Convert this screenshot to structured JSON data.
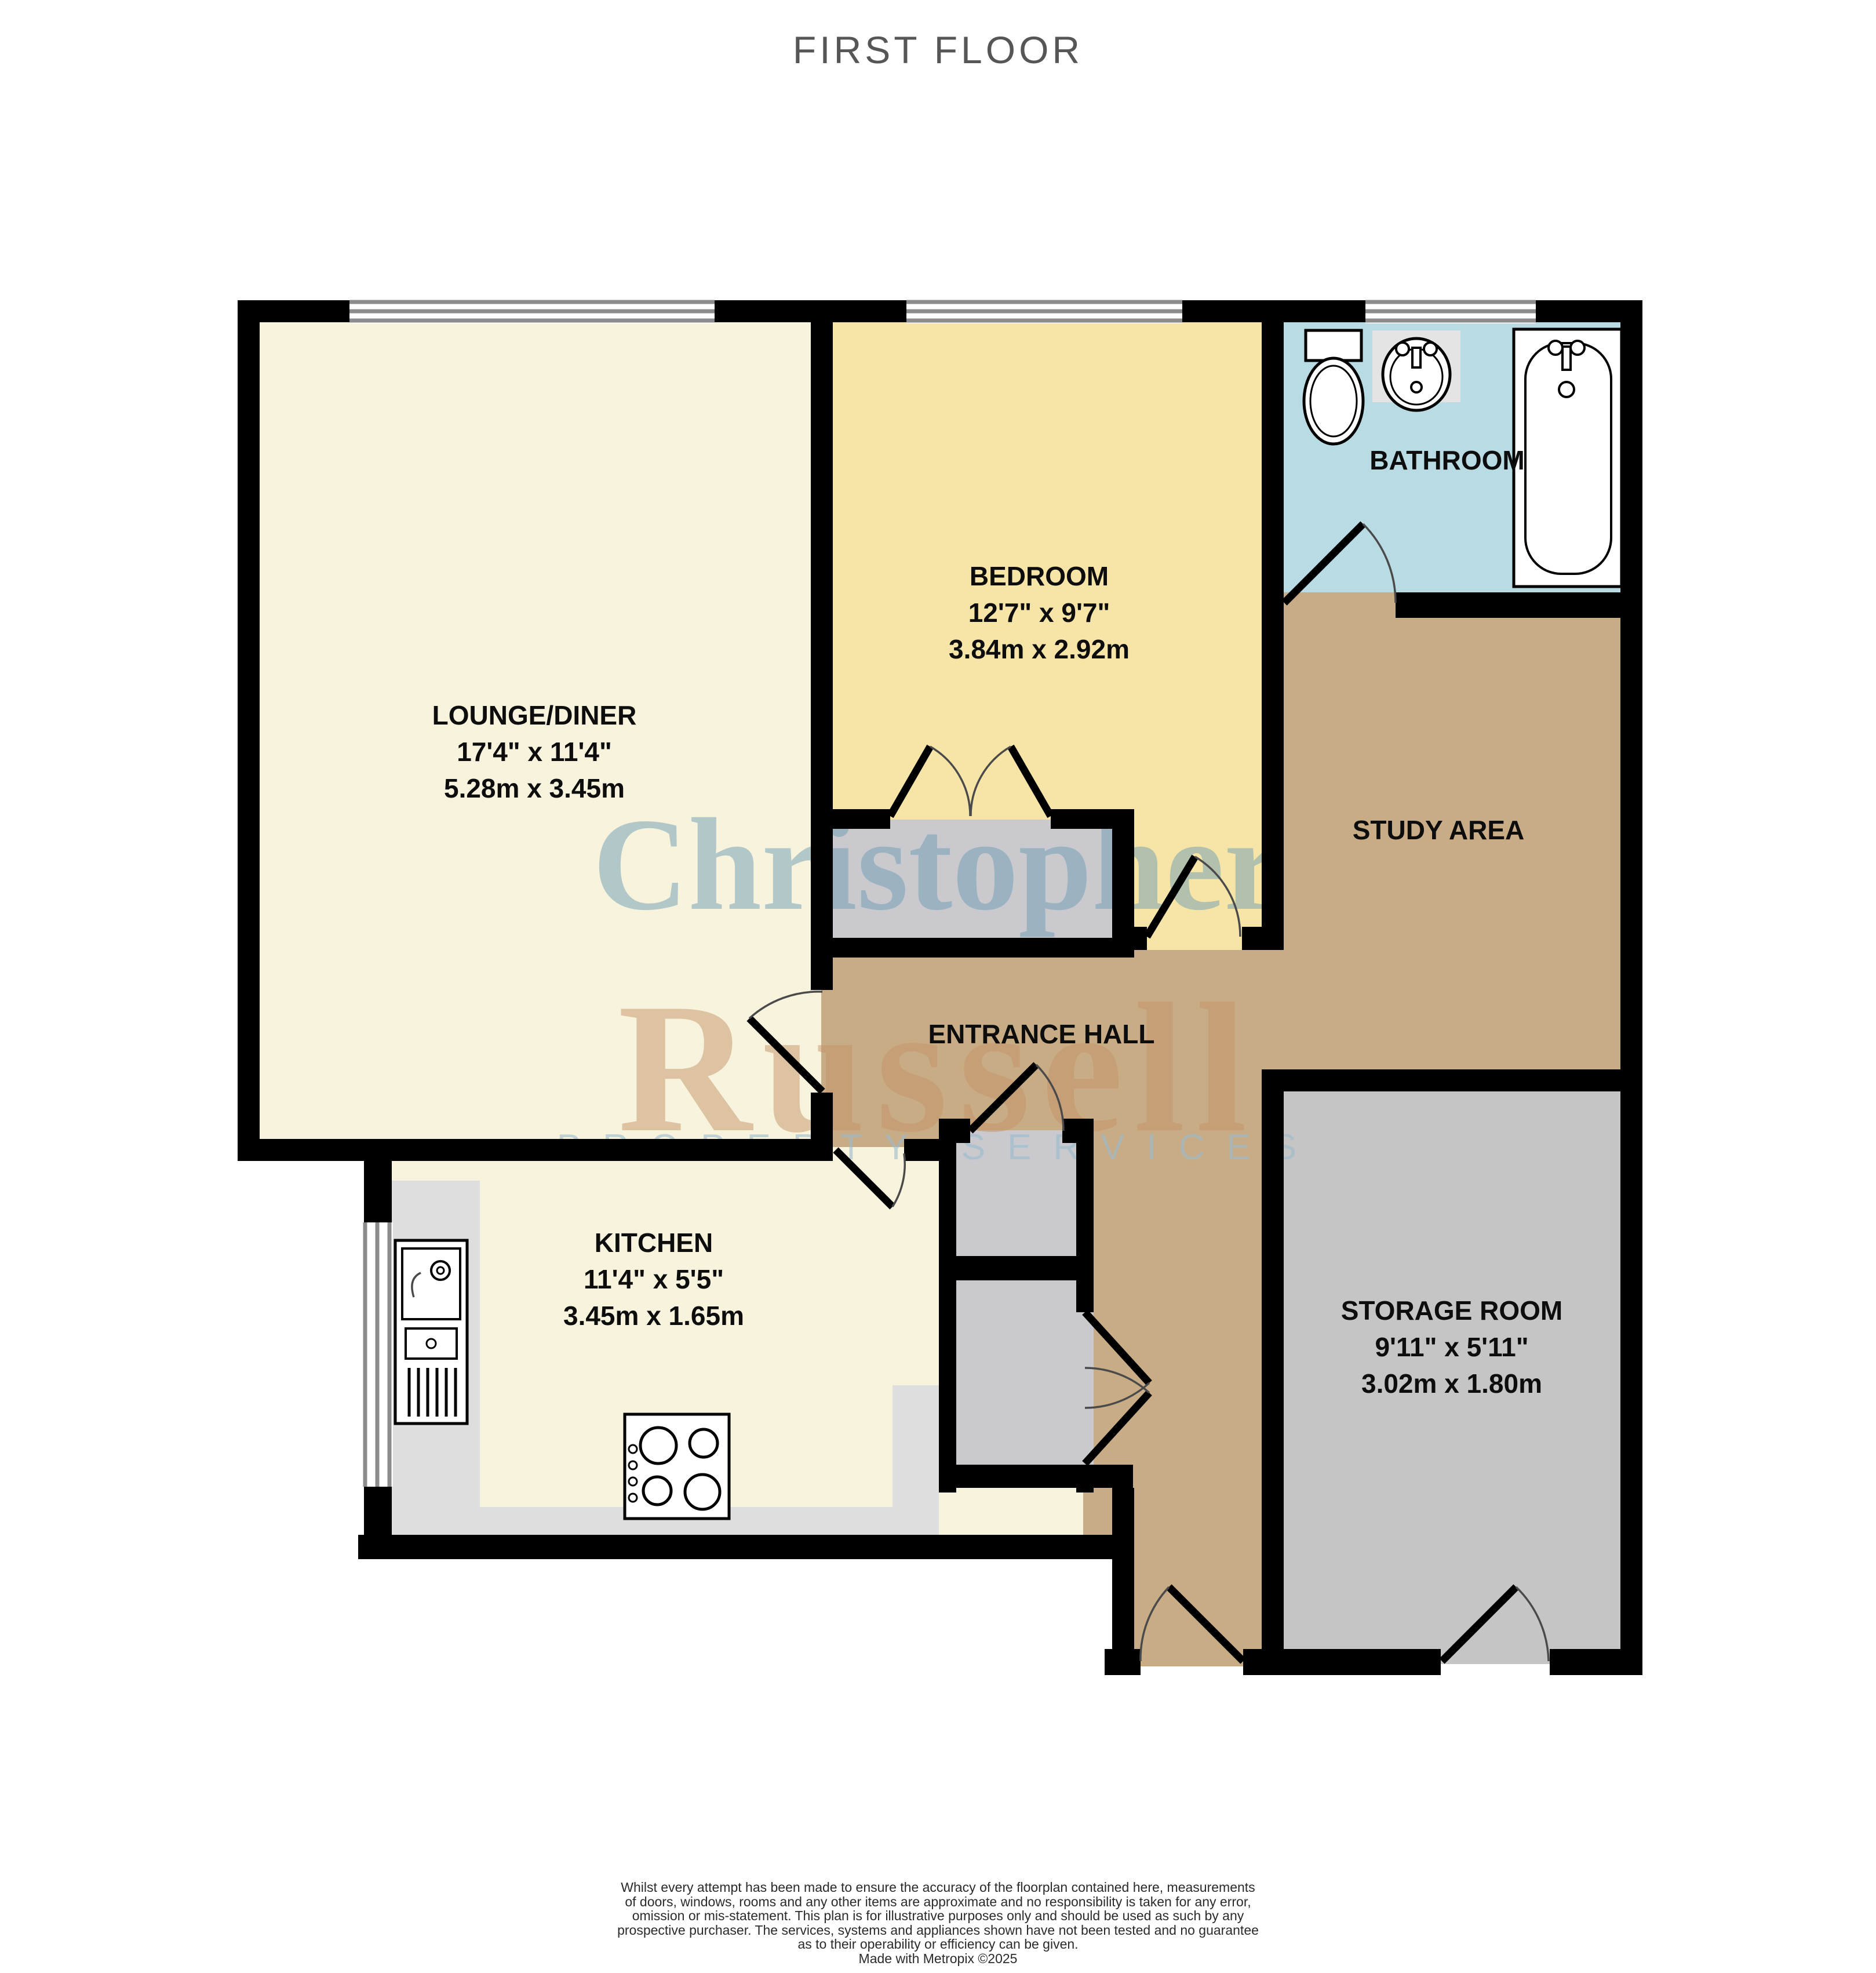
{
  "title": "FIRST FLOOR",
  "watermark": {
    "word1": "Christopher",
    "word2": "Russell",
    "tagline": "PROPERTY SERVICES"
  },
  "rooms": {
    "lounge": {
      "name": "LOUNGE/DINER",
      "imperial": "17'4\" x 11'4\"",
      "metric": "5.28m x 3.45m"
    },
    "bedroom": {
      "name": "BEDROOM",
      "imperial": "12'7\" x 9'7\"",
      "metric": "3.84m x 2.92m"
    },
    "bathroom": {
      "name": "BATHROOM"
    },
    "study": {
      "name": "STUDY AREA"
    },
    "hall": {
      "name": "ENTRANCE HALL"
    },
    "kitchen": {
      "name": "KITCHEN",
      "imperial": "11'4\" x 5'5\"",
      "metric": "3.45m x 1.65m"
    },
    "storage": {
      "name": "STORAGE ROOM",
      "imperial": "9'11\" x 5'11\"",
      "metric": "3.02m x 1.80m"
    }
  },
  "colors": {
    "lounge": "#F8F3DD",
    "kitchen": "#F8F3DD",
    "bedroom": "#F6E5A6",
    "bathroom": "#B9DCE4",
    "hall": "#C8AC86",
    "study": "#C8AC86",
    "storage": "#C5C5C5",
    "closet": "#C9C9CE",
    "counter": "#DEDEDE",
    "wall": "#000000",
    "watermark_blue": "#6F9FB5",
    "watermark_tan": "#C59468",
    "watermark_pale_blue": "#9ABCCE"
  },
  "footer": {
    "lines": [
      "Whilst every attempt has been made to ensure the accuracy of the floorplan contained here, measurements",
      "of doors, windows, rooms and any other items are approximate and no responsibility is taken for any error,",
      "omission or mis-statement. This plan is for illustrative purposes only and should be used as such by any",
      "prospective purchaser. The services, systems and appliances shown have not been tested and no guarantee",
      "as to their operability or efficiency can be given.",
      "Made with Metropix ©2025"
    ]
  }
}
